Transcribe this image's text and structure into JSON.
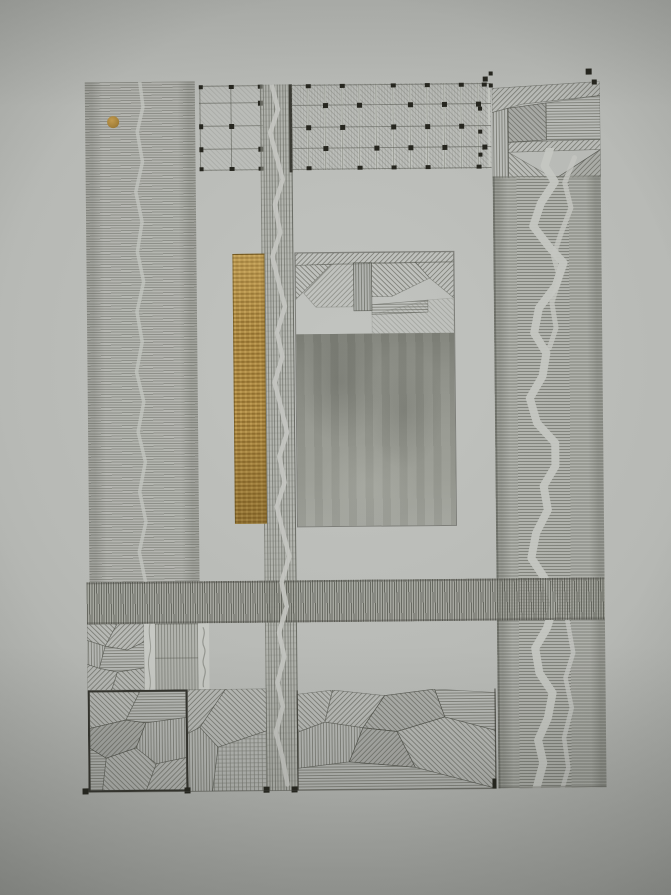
{
  "artwork": {
    "kind": "photograph-of-abstract-geometric-ink-drawing",
    "elements": {
      "left_column": "fine horizontal hatching with faint wavy void and gold dot",
      "top_band": "grid of ruled lines with small black node squares over light hatching",
      "center_strip": "vertical hatched strip with meandering white void, full height",
      "right_column": "angular hatched patchwork above horizontal hatching with two meandering white voids",
      "gold_bar": "tall narrow gold-leaf rectangle",
      "center_square": "patchwork of angled hatching above a soft graphite-shaded block",
      "middle_band": "dense vertical hatched horizontal band",
      "bottom_blocks": "angular hatched patchwork blocks, one with dark border",
      "marks": "small black registration squares at edges and grid nodes"
    }
  },
  "colors": {
    "paper": "#b7b9b5",
    "paper_center": "#c2c4c0",
    "paper_edge": "#8f918d",
    "paper_light": "#c6c8c3",
    "ink_line": "#6e7068",
    "ink_dark": "#3a3a33",
    "ink_node": "#26261f",
    "gold": "#a5813a",
    "gold_light": "#c19a4e",
    "gold_dark": "#8a6b2d",
    "graphite_dark": "#7f8179",
    "graphite_light": "#a1a39c"
  }
}
